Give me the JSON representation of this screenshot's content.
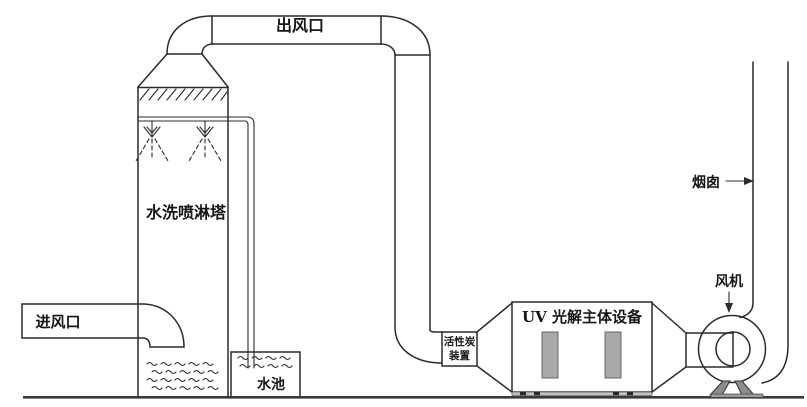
{
  "diagram": {
    "labels": {
      "outlet": "出风口",
      "tower": "水洗喷淋塔",
      "inlet": "进风口",
      "pool": "水池",
      "carbon_line1": "活性炭",
      "carbon_line2": "装置",
      "uv": "UV 光解主体设备",
      "chimney": "烟囱",
      "fan": "风机"
    },
    "colors": {
      "line": "#2b2b2b",
      "ground": "#3a3a3a",
      "lamp_fill": "#a9a9a9",
      "leg_fill": "#8c8c8c",
      "base_fill": "#9a9a9a",
      "rail_fill": "#c0c0c0",
      "background": "#ffffff"
    }
  }
}
